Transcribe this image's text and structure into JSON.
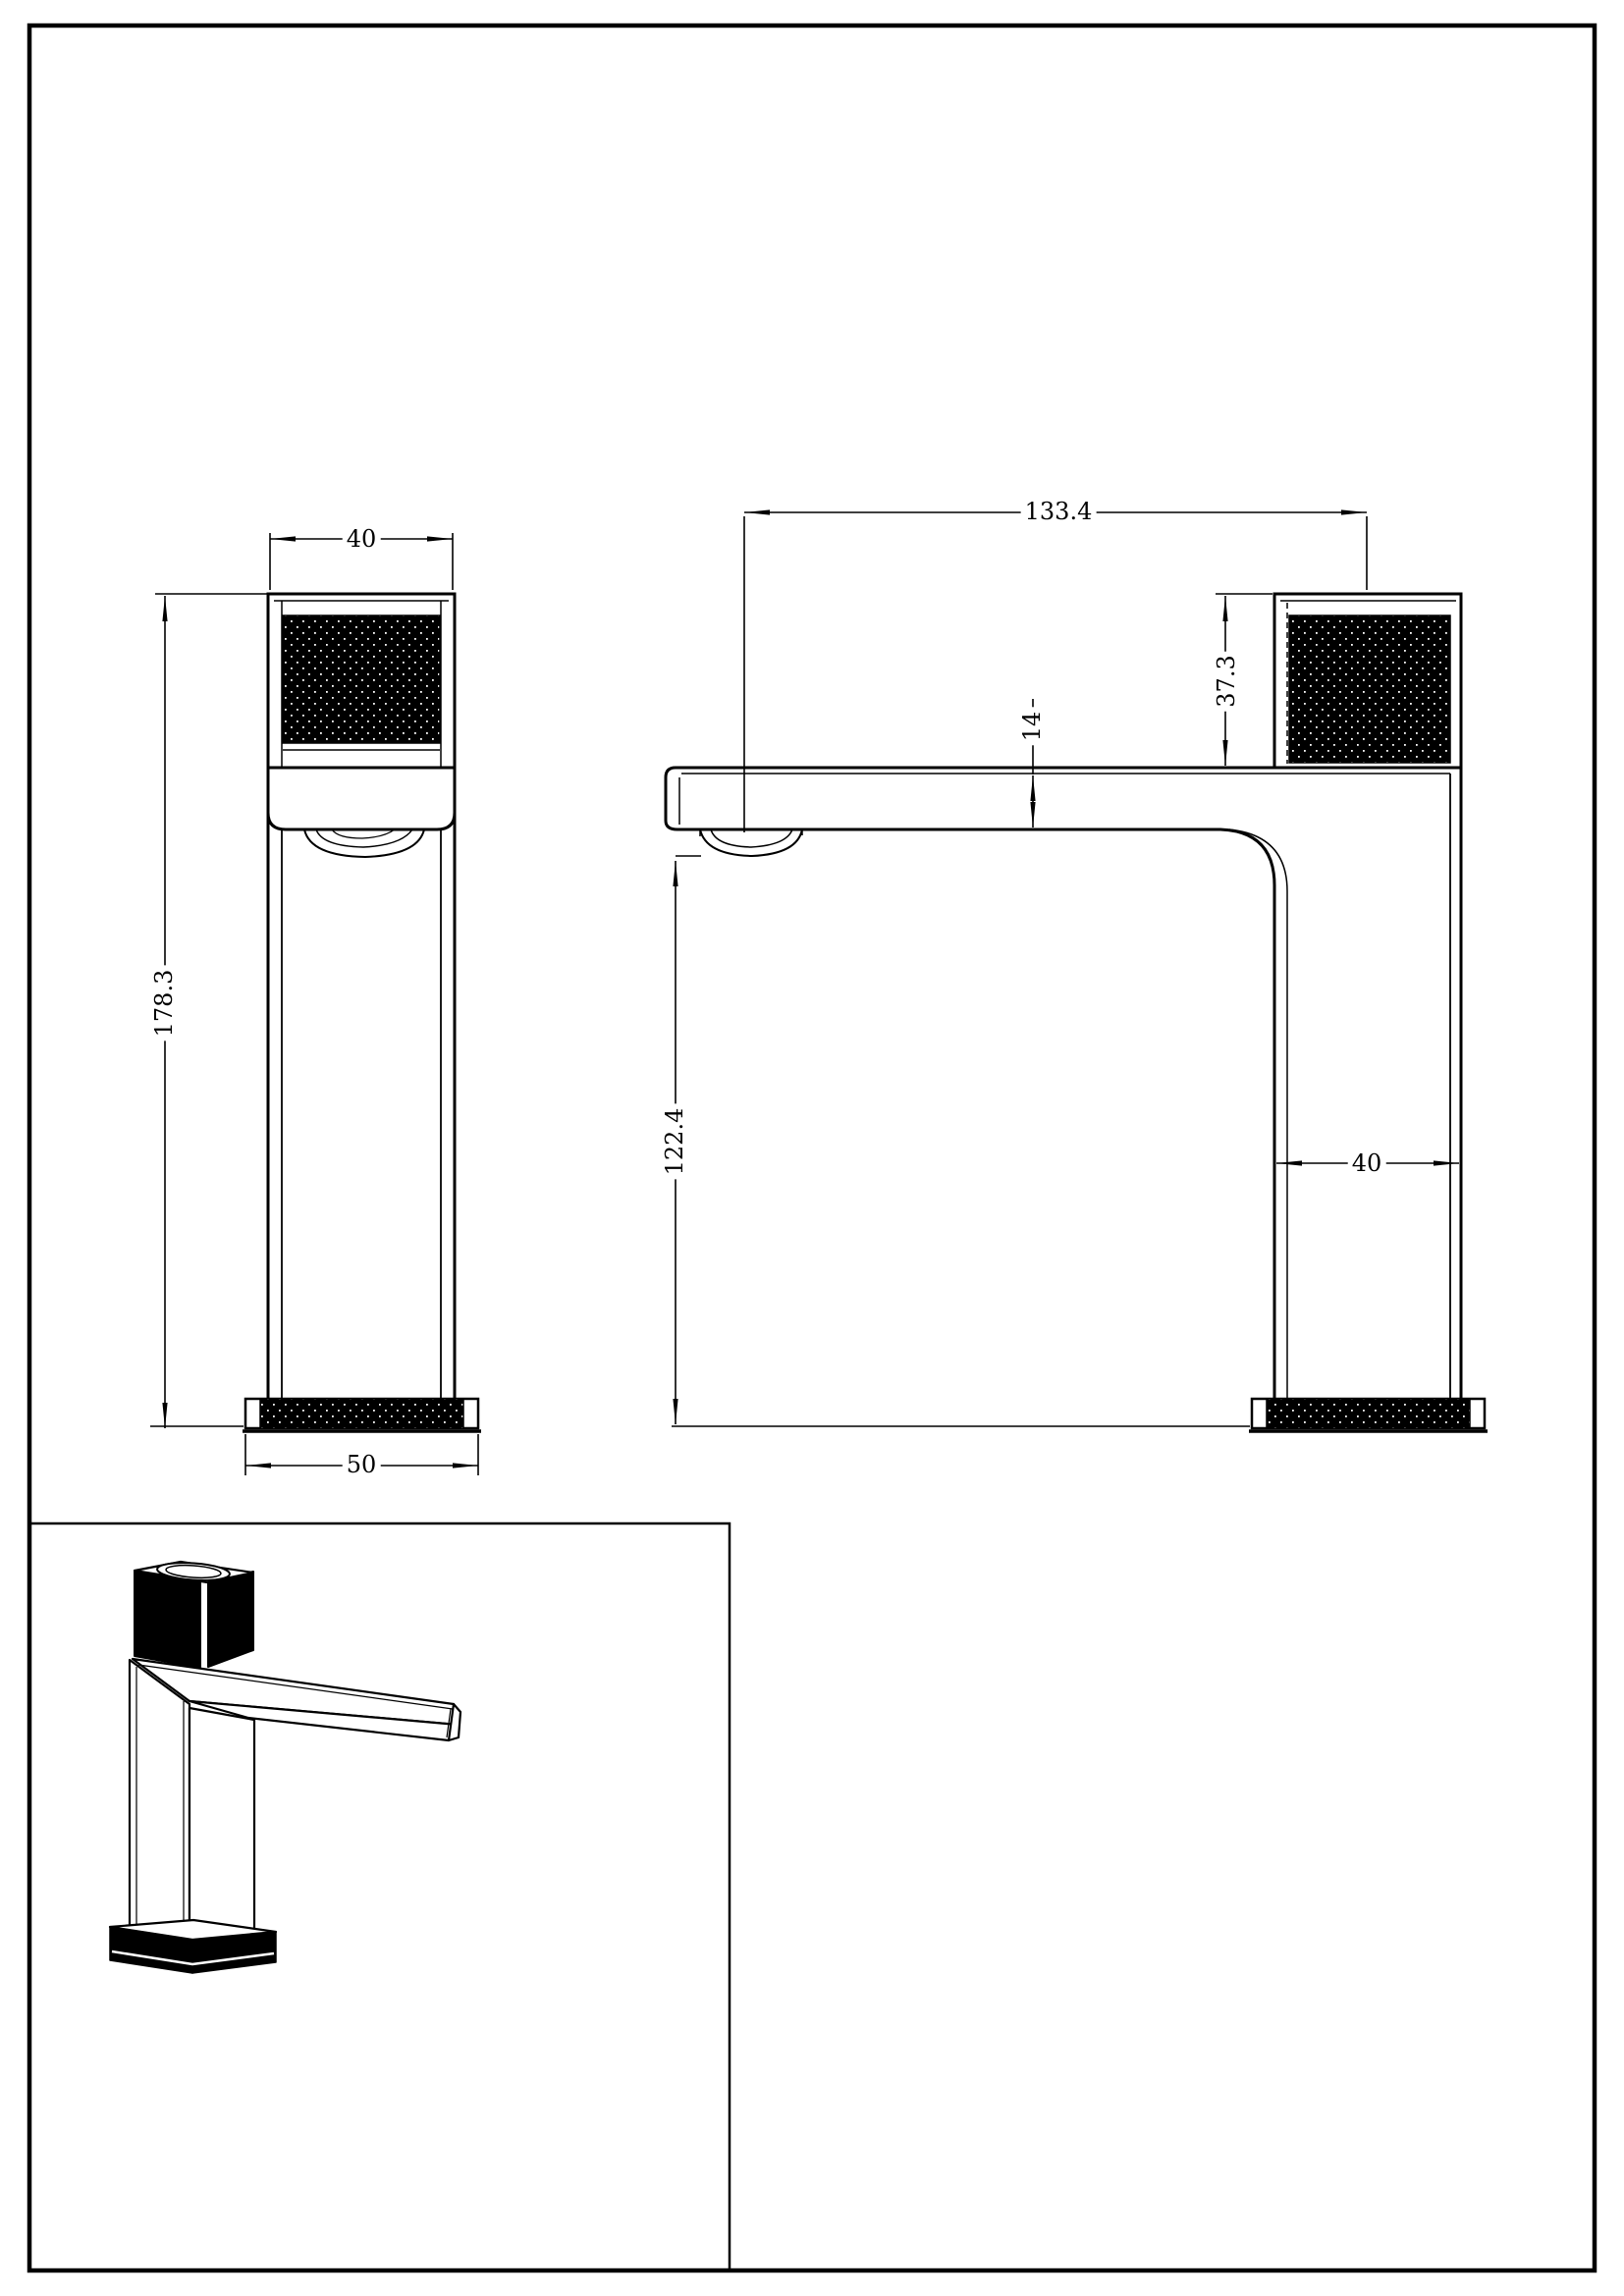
{
  "sheet": {
    "type": "technical-drawing",
    "subject": "basin faucet (mixer tap) orthographic and isometric views",
    "background_color": "#ffffff",
    "line_color": "#000000"
  },
  "views": {
    "front": {
      "name": "front view",
      "dims": {
        "handle_width": "40",
        "overall_height": "178.3",
        "base_width": "50"
      }
    },
    "side": {
      "name": "side view",
      "dims": {
        "overall_length": "133.4",
        "handle_height": "37.3",
        "spout_thickness": "14",
        "spout_clearance": "122.4",
        "body_depth": "40"
      }
    },
    "isometric": {
      "name": "isometric view"
    }
  }
}
